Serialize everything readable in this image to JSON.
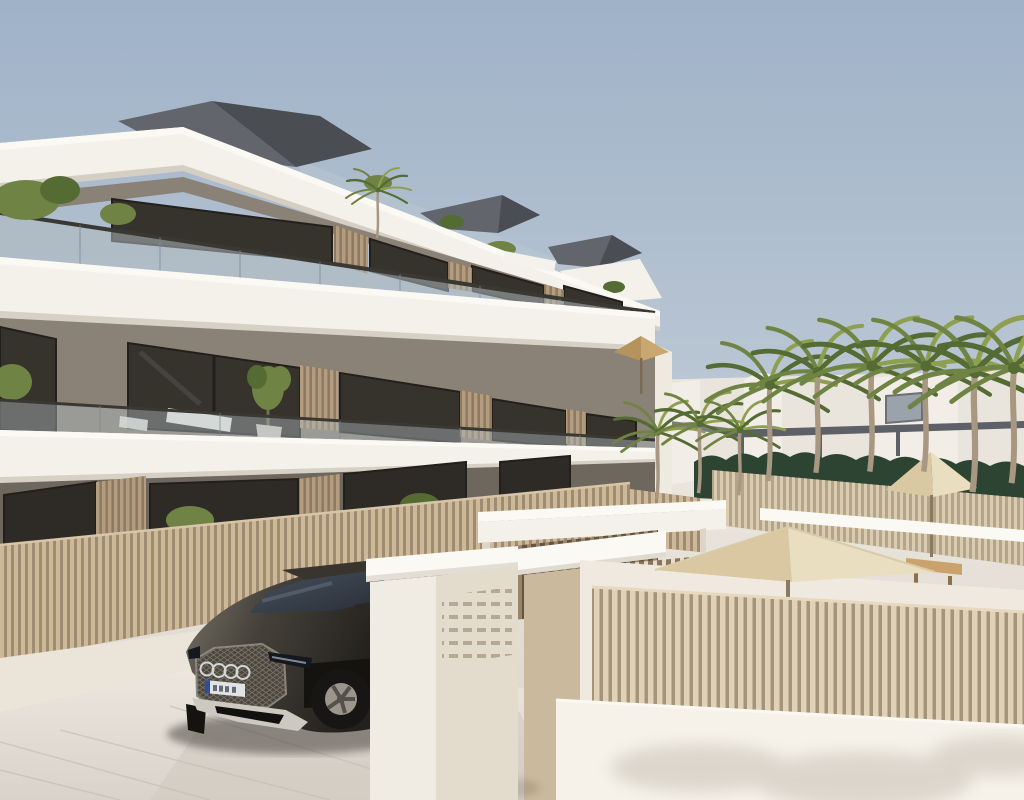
{
  "meta": {
    "title": "New-build apartment complex — exterior 3D visualization",
    "view": "Street corner with garage entrance, parked SUV, communal pool terrace and palm trees",
    "time_of_day": "clear daylight"
  },
  "scene": {
    "building": {
      "floors": 3,
      "style": "modern flat-roof apartment block",
      "features": [
        "white wrap-around balcony slabs",
        "glass balustrades",
        "wooden vertical slat privacy screens",
        "floor-to-ceiling dark-framed windows",
        "roof terrace volumes",
        "balcony plants and loungers"
      ]
    },
    "vehicle": {
      "kind": "dark SUV with illuminated-style front grille and four-ring badge",
      "position": "exiting driveway, partly hidden behind white gate pillar",
      "license_plate_legible": false
    },
    "entrance": {
      "elements": [
        "white pillar with ventilation slot grid",
        "beige pillar with white cap",
        "white lintel beams",
        "vertical timber slat gate"
      ]
    },
    "landscaping": {
      "palm_count": 10,
      "hedge": true,
      "fencing": "vertical wooden slat fences on low rendered walls"
    },
    "amenities": {
      "umbrellas": 3,
      "pool_terrace": true,
      "outdoor_dining_table": true,
      "sun_loungers": 3
    }
  },
  "colors": {
    "sky_top": "#9fb2c8",
    "sky_horizon": "#c6cfd8",
    "slab": "#f4f1ea",
    "slab_bright": "#fbf9f4",
    "slab_shadow": "#c9c2b5",
    "facade": "#8a8177",
    "facade_dark": "#6e675d",
    "glass": "#36322c",
    "glass_dark": "#2e2a25",
    "frame": "#23201c",
    "balustrade": "#aeb9bd",
    "rail": "#3a3833",
    "wood": "#b49d7e",
    "wood_dark": "#8d7a60",
    "fence_slat": "#cdb897",
    "fence_gap": "#9e8b72",
    "roof": "#62656b",
    "roof_dark": "#4a4d52",
    "roof_glass": "#b9c6d2",
    "green": "#6f8444",
    "green_dark": "#546b33",
    "trunk": "#a89781",
    "hedge": "#2c4431",
    "umbrella": "#e9dec0",
    "umbrella_shade": "#d9c8a2",
    "umbrella_tan": "#c9a770",
    "wall_white": "#ebe4d9",
    "wall_bright": "#f6f2ea",
    "pavement": "#e6e2da",
    "pavement_dark": "#cfc9c0",
    "joint": "#c4beb4",
    "beige": "#cbb99e",
    "beige_dark": "#b9a689",
    "vent": "#b5a995",
    "car_body": "#45413a",
    "car_body_light": "#7a756a",
    "car_dark": "#23211d",
    "car_glass": "#2a2f38",
    "tire": "#181614",
    "rim": "#9a968c",
    "chrome": "#d3d5d6",
    "plate": "#e1e4e6",
    "plate_blue": "#2b4f9e",
    "table_wood": "#c9a26c",
    "chair_wood": "#8f6f47",
    "bg_wall": "#eae5dc",
    "bg_building": "#f2eee7",
    "bg_window": "#9aa2ab",
    "pergola": "#5d6066"
  }
}
